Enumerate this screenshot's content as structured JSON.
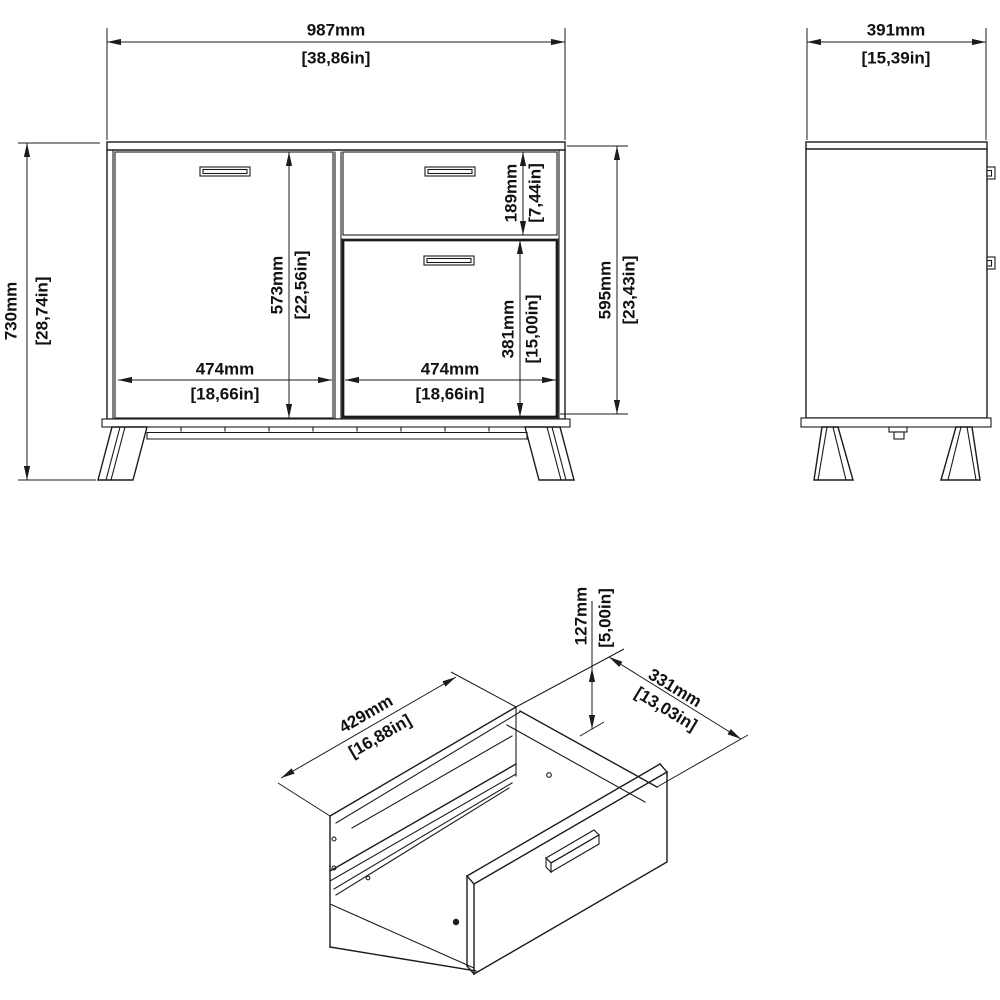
{
  "drawing": {
    "type": "furniture dimension sheet",
    "units": [
      "mm",
      "in"
    ],
    "front_view": {
      "width_mm": "987mm",
      "width_in": "[38,86in]",
      "height_mm": "730mm",
      "height_in": "[28,74in]",
      "door_height_mm": "573mm",
      "door_height_in": "[22,56in]",
      "drawer_front_height_mm": "189mm",
      "drawer_front_height_in": "[7,44in]",
      "bottom_door_height_mm": "381mm",
      "bottom_door_height_in": "[15,00in]",
      "front_total_height_mm": "595mm",
      "front_total_height_in": "[23,43in]",
      "left_door_width_mm": "474mm",
      "left_door_width_in": "[18,66in]",
      "right_section_width_mm": "474mm",
      "right_section_width_in": "[18,66in]"
    },
    "side_view": {
      "depth_mm": "391mm",
      "depth_in": "[15,39in]"
    },
    "drawer_view": {
      "box_height_mm": "127mm",
      "box_height_in": "[5,00in]",
      "box_depth_mm": "331mm",
      "box_depth_in": "[13,03in]",
      "box_width_mm": "429mm",
      "box_width_in": "[16,88in]"
    },
    "line_color": "#1b1b1b",
    "background_color": "#ffffff"
  }
}
